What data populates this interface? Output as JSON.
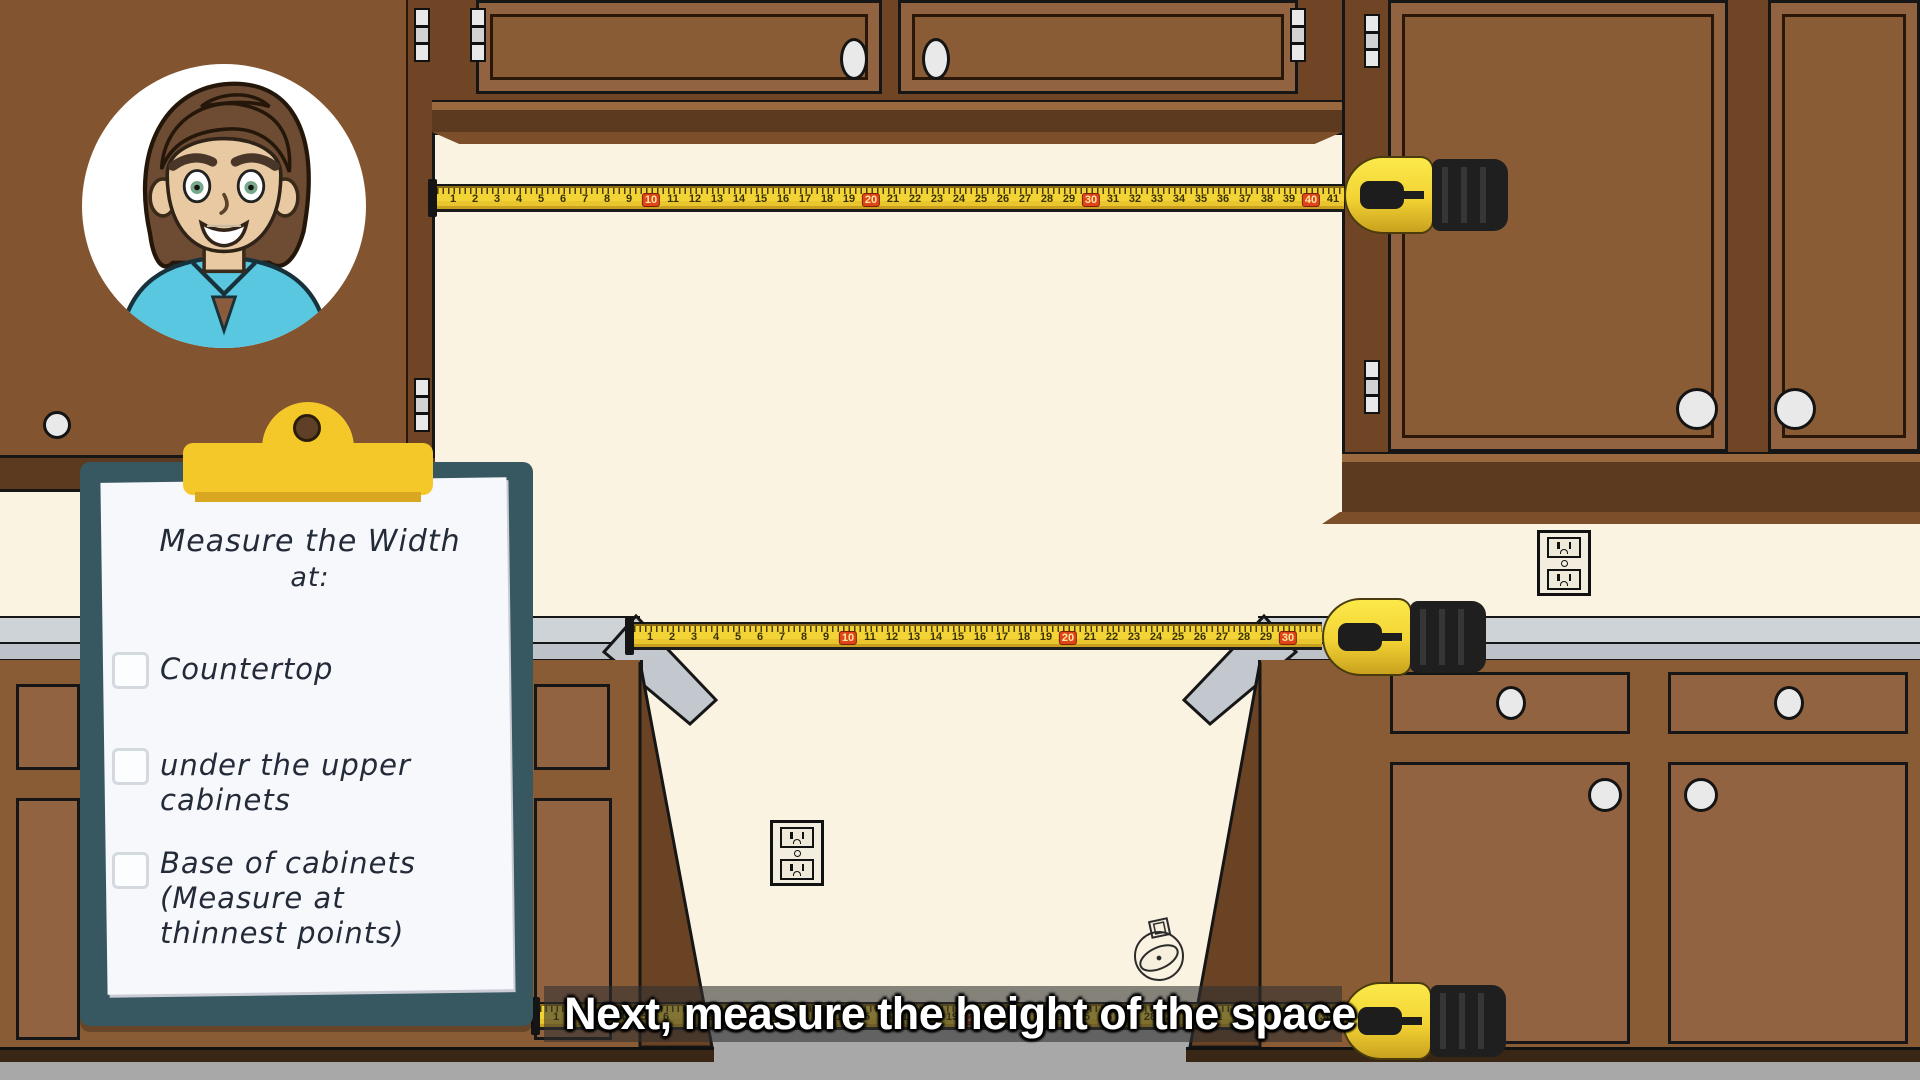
{
  "avatar": {
    "icon": "man-avatar"
  },
  "clipboard": {
    "title": "Measure the Width",
    "title_suffix": "at:",
    "items": [
      {
        "label_lines": [
          "Countertop"
        ],
        "checked": false
      },
      {
        "label_lines": [
          "under the upper",
          "cabinets"
        ],
        "checked": false
      },
      {
        "label_lines": [
          "Base of cabinets",
          "(Measure at",
          "thinnest points)"
        ],
        "checked": false
      }
    ]
  },
  "caption": {
    "text": "Next, measure the height of the space"
  },
  "tapes": [
    {
      "name": "upper-tape",
      "max_number": 41,
      "red_interval": 10
    },
    {
      "name": "counter-tape",
      "max_number": 30,
      "red_interval": 10
    },
    {
      "name": "floor-tape",
      "max_number": 36,
      "red_interval": 10
    }
  ],
  "icons": {
    "outlet": "power-outlet-icon",
    "ring": "ring-doodle-icon"
  },
  "colors": {
    "wall": "#fbf3e1",
    "cabinet": "#8a5c36",
    "cabinet_dark": "#5f3b20",
    "countertop": "#ced3d8",
    "floor": "#a8a8a8",
    "tape_yellow": "#f2d437",
    "tape_red": "#e0451a",
    "clipboard_board": "#375761",
    "clip_yellow": "#f5c829",
    "paper": "#f7f8fc",
    "caption_text": "#ffffff"
  }
}
